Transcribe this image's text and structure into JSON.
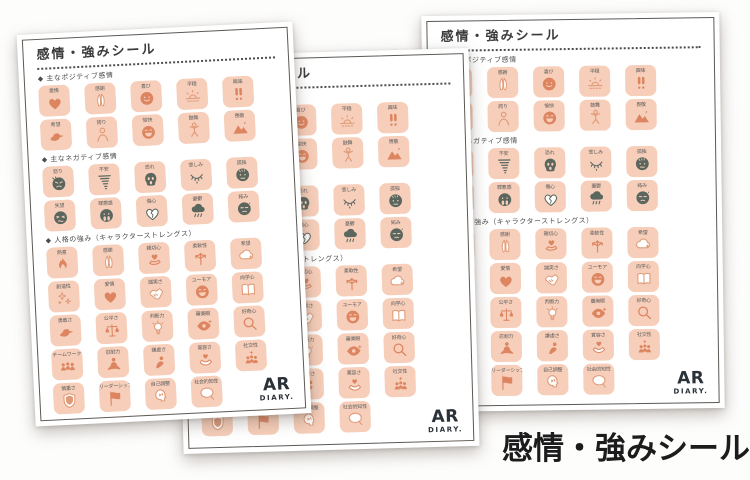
{
  "caption": "感情・強みシール",
  "colors": {
    "sticker_bg": "#f6ceb9",
    "icon_orange": "#dd8560",
    "icon_dark": "#5a665e",
    "page_border": "#5c5954",
    "caption_text": "#1c1c1c"
  },
  "sheet": {
    "title": "感情・強みシール",
    "logo": {
      "name": "AR",
      "sub": "DIARY."
    },
    "sections": [
      {
        "label": "◆ 主なポジティブ感情",
        "stickers": [
          {
            "label": "愛情",
            "icon": "heart",
            "tone": "solid"
          },
          {
            "label": "感謝",
            "icon": "pray",
            "tone": "outline"
          },
          {
            "label": "喜び",
            "icon": "smile",
            "tone": "solid"
          },
          {
            "label": "平穏",
            "icon": "sunrise",
            "tone": "outline"
          },
          {
            "label": "興味",
            "icon": "exclaim",
            "tone": "solid"
          },
          {
            "label": "希望",
            "icon": "bird",
            "tone": "solid"
          },
          {
            "label": "誇り",
            "icon": "person",
            "tone": "outline"
          },
          {
            "label": "愉快",
            "icon": "laugh",
            "tone": "solid"
          },
          {
            "label": "鼓舞",
            "icon": "jump",
            "tone": "outline"
          },
          {
            "label": "畏敬",
            "icon": "mountain",
            "tone": "solid"
          }
        ]
      },
      {
        "label": "◆ 主なネガティブ感情",
        "stickers": [
          {
            "label": "怒り",
            "icon": "angry",
            "tone": "dark"
          },
          {
            "label": "不安",
            "icon": "tornado",
            "tone": "dark"
          },
          {
            "label": "恐れ",
            "icon": "scream",
            "tone": "dark"
          },
          {
            "label": "悲しみ",
            "icon": "tear-eye",
            "tone": "dark"
          },
          {
            "label": "孤独",
            "icon": "gloomy",
            "tone": "dark"
          },
          {
            "label": "失望",
            "icon": "disappoint",
            "tone": "dark"
          },
          {
            "label": "罪悪感",
            "icon": "guilty",
            "tone": "dark"
          },
          {
            "label": "傷心",
            "icon": "broken-heart",
            "tone": "dark"
          },
          {
            "label": "憂鬱",
            "icon": "rain-cloud",
            "tone": "dark"
          },
          {
            "label": "妬み",
            "icon": "envy",
            "tone": "dark"
          }
        ]
      },
      {
        "label": "◆ 人格の強み（キャラクターストレングス）",
        "stickers": [
          {
            "label": "熱意",
            "icon": "flame",
            "tone": "solid"
          },
          {
            "label": "感謝",
            "icon": "pray",
            "tone": "outline"
          },
          {
            "label": "親切心",
            "icon": "hand-heart",
            "tone": "solid"
          },
          {
            "label": "柔軟性",
            "icon": "arrows",
            "tone": "solid"
          },
          {
            "label": "希望",
            "icon": "cloud",
            "tone": "outline"
          },
          {
            "label": "創造性",
            "icon": "sparkles",
            "tone": "outline"
          },
          {
            "label": "愛情",
            "icon": "heart",
            "tone": "solid"
          },
          {
            "label": "誠実さ",
            "icon": "handshake",
            "tone": "outline"
          },
          {
            "label": "ユーモア",
            "icon": "laugh",
            "tone": "solid"
          },
          {
            "label": "向学心",
            "icon": "book",
            "tone": "outline"
          },
          {
            "label": "勇敢さ",
            "icon": "bird",
            "tone": "solid"
          },
          {
            "label": "公平さ",
            "icon": "scales",
            "tone": "solid"
          },
          {
            "label": "判断力",
            "icon": "bulb",
            "tone": "outline"
          },
          {
            "label": "審美眼",
            "icon": "eye",
            "tone": "solid"
          },
          {
            "label": "好奇心",
            "icon": "magnifier",
            "tone": "solid"
          },
          {
            "label": "チームワーク",
            "icon": "team",
            "tone": "solid"
          },
          {
            "label": "忍耐力",
            "icon": "meditate",
            "tone": "solid"
          },
          {
            "label": "謙虚さ",
            "icon": "bow",
            "tone": "solid"
          },
          {
            "label": "寛容さ",
            "icon": "hold-heart",
            "tone": "solid"
          },
          {
            "label": "社交性",
            "icon": "group",
            "tone": "solid"
          },
          {
            "label": "慎重さ",
            "icon": "shield",
            "tone": "outline"
          },
          {
            "label": "リーダーシップ",
            "icon": "flag",
            "tone": "solid"
          },
          {
            "label": "自己調整",
            "icon": "head",
            "tone": "outline"
          },
          {
            "label": "社会的知性",
            "icon": "bubble",
            "tone": "outline"
          }
        ]
      }
    ]
  }
}
